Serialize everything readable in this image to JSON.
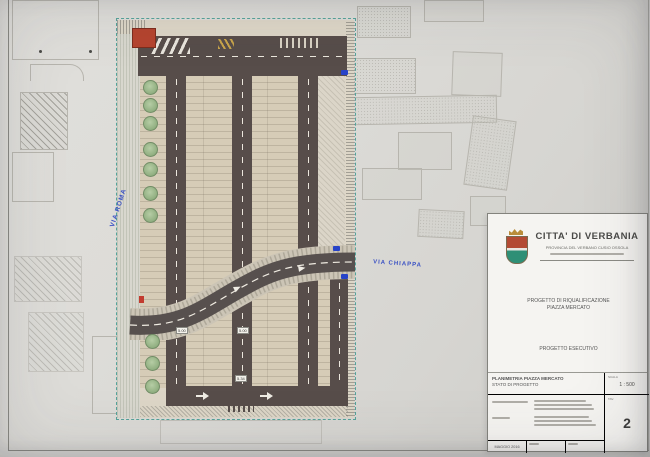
{
  "plan": {
    "street_labels": {
      "via_roma": "VIA ROMA",
      "via_chiappa": "VIA CHIAPPA"
    },
    "dimension_tags": [
      {
        "value": "5.00"
      },
      {
        "value": "5.00"
      },
      {
        "value": "5.34"
      }
    ],
    "colors": {
      "road": "#574d4a",
      "parking": "#d6ccb7",
      "tree_green": "#93b183",
      "plan_border_teal": "#55a39a",
      "street_label_blue": "#3b52c4",
      "marker_blue": "#2743c8",
      "marker_red": "#c23b2e"
    }
  },
  "title_block": {
    "city": "CITTA' DI VERBANIA",
    "province": "PROVINCIA DEL VERBANO CUSIO OSSOLA",
    "project_line1": "PROGETTO DI RIQUALIFICAZIONE",
    "project_line2": "PIAZZA MERCATO",
    "phase": "PROGETTO ESECUTIVO",
    "drawing_line1": "PLANIMETRIA PIAZZA MERCATO",
    "drawing_line2": "STATO DI PROGETTO",
    "scale_label": "SCALA",
    "scale_value": "1 : 500",
    "sheet_label": "TAV.",
    "sheet_number": "2",
    "date": "MAGGIO 2016"
  }
}
